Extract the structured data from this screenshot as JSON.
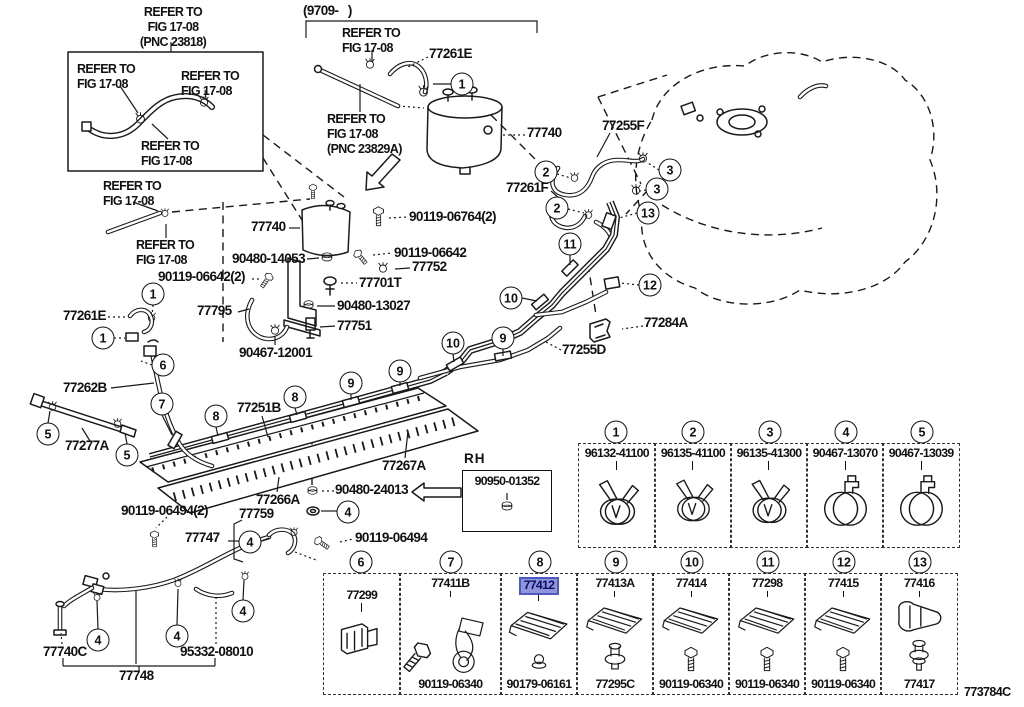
{
  "figure_code": "773784C",
  "highlight_color": "#8e96d9",
  "nums": {
    "n1": "1",
    "n2": "2",
    "n3": "3",
    "n4": "4",
    "n5": "5",
    "n6": "6",
    "n7": "7",
    "n8": "8",
    "n9": "9",
    "n10": "10",
    "n11": "11",
    "n12": "12",
    "n13": "13"
  },
  "notes": {
    "refer_pnc23818": "REFER TO\nFIG 17-08\n(PNC 23818)",
    "refer": "REFER TO\nFIG 17-08",
    "refer_pnc23829a": "REFER TO\nFIG 17-08\n(PNC 23829A)",
    "model_range": "(9709-   )",
    "rh": "RH"
  },
  "parts": {
    "p77261e": "77261E",
    "p77740": "77740",
    "p77255f": "77255F",
    "p77261f": "77261F",
    "p90119_06764": "90119-06764(2)",
    "p90480_14053": "90480-14053",
    "p90119_06642": "90119-06642",
    "p77752": "77752",
    "p77701t": "77701T",
    "p90480_13027": "90480-13027",
    "p77751": "77751",
    "p90119_06642_2": "90119-06642(2)",
    "p77795": "77795",
    "p90467_12001": "90467-12001",
    "p77262b": "77262B",
    "p77277a": "77277A",
    "p77251b": "77251B",
    "p77284a": "77284A",
    "p77255d": "77255D",
    "p77267a": "77267A",
    "p90950_01352": "90950-01352",
    "p90480_24013": "90480-24013",
    "p77266a": "77266A",
    "p90119_06494_2": "90119-06494(2)",
    "p77759": "77759",
    "p77747": "77747",
    "p90119_06494": "90119-06494",
    "p77740c": "77740C",
    "p95332_08010": "95332-08010",
    "p77748": "77748"
  },
  "table_row1": [
    {
      "num": "1",
      "part": "96132-41100"
    },
    {
      "num": "2",
      "part": "96135-41100"
    },
    {
      "num": "3",
      "part": "96135-41300"
    },
    {
      "num": "4",
      "part": "90467-13070"
    },
    {
      "num": "5",
      "part": "90467-13039"
    }
  ],
  "table_row2": [
    {
      "num": "6",
      "top": "77299",
      "bottom": ""
    },
    {
      "num": "7",
      "top": "77411B",
      "bottom": "90119-06340"
    },
    {
      "num": "8",
      "top": "77412",
      "bottom": "90179-06161"
    },
    {
      "num": "9",
      "top": "77413A",
      "bottom": "77295C"
    },
    {
      "num": "10",
      "top": "77414",
      "bottom": "90119-06340"
    },
    {
      "num": "11",
      "top": "77298",
      "bottom": "90119-06340"
    },
    {
      "num": "12",
      "top": "77415",
      "bottom": "90119-06340"
    },
    {
      "num": "13",
      "top": "77416",
      "bottom": "77417"
    }
  ]
}
